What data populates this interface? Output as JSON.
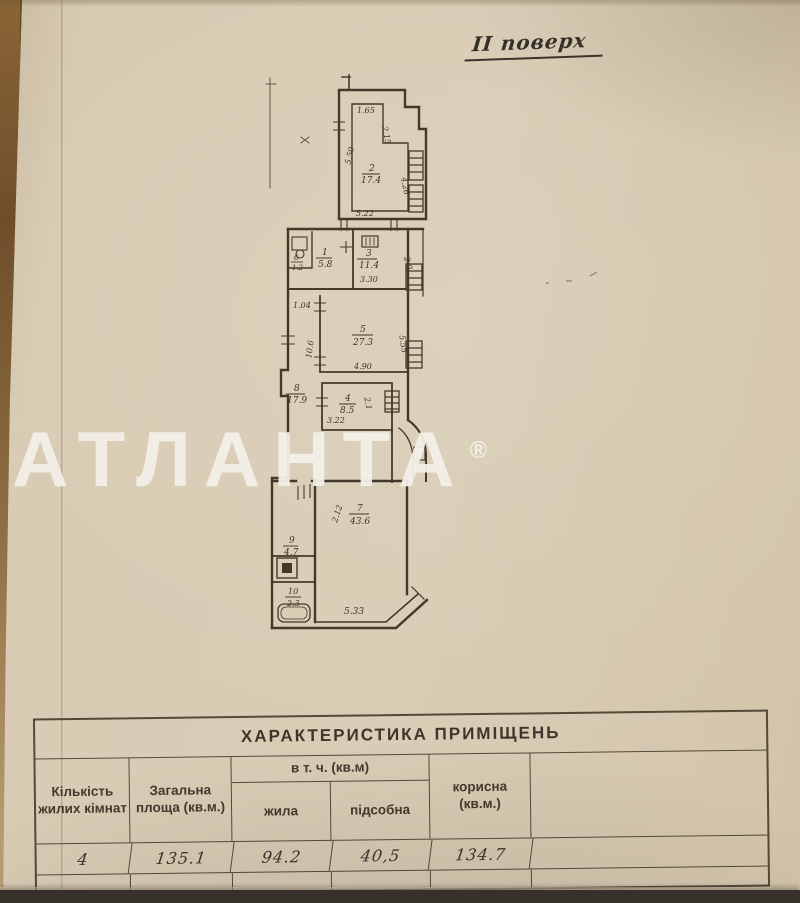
{
  "page": {
    "floor_label": "ІІ поверх"
  },
  "plan": {
    "rooms": [
      {
        "num": "2",
        "area": "17.4"
      },
      {
        "num": "1",
        "area": "5.8"
      },
      {
        "num": "3",
        "area": "11.4"
      },
      {
        "num": "6",
        "area": "1.2"
      },
      {
        "num": "5",
        "area": "27.3"
      },
      {
        "num": "8",
        "area": "17.9"
      },
      {
        "num": "4",
        "area": "8.5"
      },
      {
        "num": "7",
        "area": "43.6"
      },
      {
        "num": "9",
        "area": "4.7"
      },
      {
        "num": "10",
        "area": "2.3"
      }
    ],
    "dims": [
      "1.65",
      "2.15",
      "5.50",
      "4.26",
      "5.22",
      "3.30",
      "2.0",
      "1.04",
      "4.90",
      "5.55",
      "10.6",
      "3.22",
      "2.1",
      "2.12",
      "5.33"
    ]
  },
  "watermark": {
    "name": "АТЛАНТА",
    "reg": "®"
  },
  "table": {
    "title": "ХАРАКТЕРИСТИКА ПРИМІЩЕНЬ",
    "headers": {
      "col_rooms": "Кількість жилих кімнат",
      "col_total": "Загальна площа (кв.м.)",
      "group_incl": "в т. ч. (кв.м)",
      "col_living": "жила",
      "col_utility": "підсобна",
      "col_useful": "корисна (кв.м.)"
    },
    "values": {
      "rooms": "4",
      "total": "135.1",
      "living": "94.2",
      "utility": "40,5",
      "useful": "134.7"
    }
  }
}
